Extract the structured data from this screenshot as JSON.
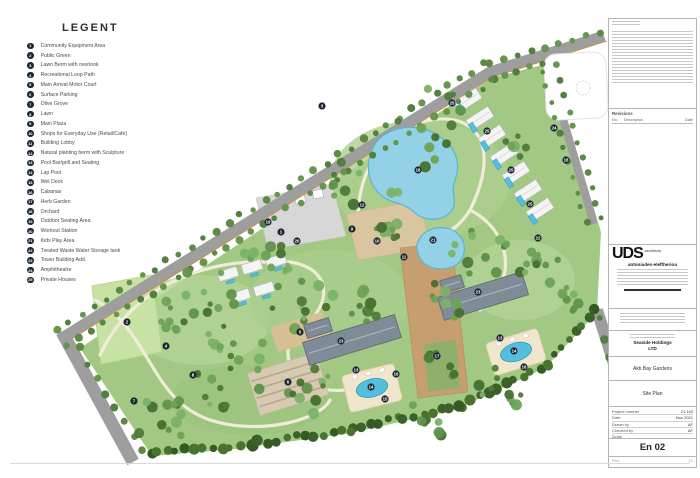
{
  "legend": {
    "title": "LEGENT",
    "items": [
      {
        "n": 1,
        "label": "Community Equipment Area"
      },
      {
        "n": 2,
        "label": "Public Green"
      },
      {
        "n": 3,
        "label": "Lawn Berm with overlook"
      },
      {
        "n": 4,
        "label": "Recreational Loop Path"
      },
      {
        "n": 5,
        "label": "Main Arrival Motor Court"
      },
      {
        "n": 6,
        "label": "Surface Parking"
      },
      {
        "n": 7,
        "label": "Olive Grove"
      },
      {
        "n": 8,
        "label": "Lawn"
      },
      {
        "n": 9,
        "label": "Main Plaza"
      },
      {
        "n": 10,
        "label": "Shops for Everyday Use (Retail/Cafe)"
      },
      {
        "n": 11,
        "label": "Building Lobby"
      },
      {
        "n": 12,
        "label": "Natural planting berm with Sculpture"
      },
      {
        "n": 13,
        "label": "Pool Bar/grill and Seating"
      },
      {
        "n": 14,
        "label": "Lap Pool"
      },
      {
        "n": 15,
        "label": "Wet Deck"
      },
      {
        "n": 16,
        "label": "Cabanas"
      },
      {
        "n": 17,
        "label": "Herb Garden"
      },
      {
        "n": 18,
        "label": "Orchard"
      },
      {
        "n": 19,
        "label": "Outdoor Seating Area"
      },
      {
        "n": 20,
        "label": "Workout Station"
      },
      {
        "n": 21,
        "label": "Kids Play Area"
      },
      {
        "n": 22,
        "label": "Treated Waste Water Storage tank"
      },
      {
        "n": 23,
        "label": "Tower Building Add."
      },
      {
        "n": 24,
        "label": "Amphitheatre"
      },
      {
        "n": 25,
        "label": "Private Houses"
      }
    ]
  },
  "title_block": {
    "revisions_title": "Revisions",
    "revision_columns": [
      "No.",
      "Description",
      "Date"
    ],
    "logo": "UDS",
    "logo_sub": "architects",
    "firm": "antoniades-eleftheriou",
    "client_line1": "Seaside Holdings",
    "client_line2": "LTD",
    "project": "Akti Bay Gardens",
    "drawing": "Site Plan",
    "fields": [
      {
        "label": "Project number",
        "value": "21.140"
      },
      {
        "label": "Date",
        "value": "Nov 2021"
      },
      {
        "label": "Drawn by",
        "value": "AF"
      },
      {
        "label": "Checked by",
        "value": "AF"
      },
      {
        "label": "Scale",
        "value": ""
      }
    ],
    "sheet": "En 02",
    "print_label": "Print",
    "print_value": "1:2"
  },
  "site_plan": {
    "colors": {
      "park": "#a3c883",
      "lawn": "#c8e2a4",
      "road": "#9e9e9e",
      "road_accent": "#cd8a42",
      "pond_fill": "#93d2e6",
      "pond_edge": "#5db3cf",
      "pool_fill": "#55bedd",
      "pool_edge": "#2f9fc2",
      "deck": "#f0e6cc",
      "deck_edge": "#d9cba6",
      "plaza_gray": "#d7d7d7",
      "plaza_tan": "#d9c6a0",
      "axis_tan": "#c79e6f",
      "tower": "#7f8b97",
      "tower_edge": "#5d6873",
      "villa": "#f4f4f4",
      "villa_edge": "#b9b9b9",
      "parking": "#d6cab2",
      "marker": "#1d2734",
      "path": "#f1ecd9"
    },
    "park_outline": "80,348 492,78 550,63 601,232 597,312 545,368 455,410 345,434 235,449 152,456",
    "patches": [
      [
        200,
        320,
        70,
        45,
        "#b2d395"
      ],
      [
        420,
        180,
        90,
        60,
        "#aed08e"
      ],
      [
        330,
        300,
        80,
        50,
        "#a9cd8b"
      ],
      [
        520,
        280,
        55,
        40,
        "#b2d395"
      ],
      [
        250,
        400,
        80,
        35,
        "#9cc47e"
      ]
    ],
    "lawn_quad": "92,286 152,275 162,352 101,364",
    "paths": [
      "M 100,355 C 130,290 200,260 265,262",
      "M 95,300 C 150,330 150,400 210,420 C 260,436 320,420 330,400",
      "M 265,262 C 330,255 340,300 300,330 C 270,355 300,395 345,390",
      "M 360,240 C 350,180 380,130 430,120 C 480,112 500,150 470,210 C 455,235 420,250 395,250",
      "M 470,210 C 510,230 520,280 480,310"
    ],
    "plaza_gray_poly": "256,198 332,184 346,236 268,250",
    "pergolas": [
      [
        280,
        205
      ],
      [
        300,
        199
      ],
      [
        318,
        194
      ]
    ],
    "plaza_tan_poly": "346,214 420,200 430,248 358,260",
    "fountain": [
      388,
      229,
      7
    ],
    "axis_poly": "400,248 452,242 468,392 418,398",
    "courtyard_poly": "424,344 456,340 460,388 428,392",
    "motor_court": {
      "cx": 300,
      "cy": 332,
      "w": 54,
      "h": 26,
      "rot": -17
    },
    "parking": {
      "cx": 288,
      "cy": 384,
      "w": 72,
      "h": 44,
      "rot": -17,
      "stripes": 4
    },
    "roads": [
      {
        "points": [
          [
            62,
            338
          ],
          [
            490,
            72
          ],
          [
            604,
            36
          ]
        ],
        "width": 11
      },
      {
        "points": [
          [
            62,
            332
          ],
          [
            133,
            462
          ]
        ],
        "width": 13
      },
      {
        "points": [
          [
            548,
            68
          ],
          [
            594,
            224
          ]
        ],
        "width": 8
      },
      {
        "points": [
          [
            597,
            310
          ],
          [
            635,
            430
          ]
        ],
        "width": 12
      }
    ],
    "accent_road": 0,
    "white_plot": {
      "cx": 576,
      "cy": 86,
      "w": 62,
      "h": 66,
      "r": 12,
      "rot": -3
    },
    "plot_circle": [
      583,
      88,
      7
    ],
    "ponds": [
      "M 372,150 C 380,128 412,122 432,132 C 455,143 462,162 455,180 C 450,193 458,200 452,210 C 444,222 424,222 414,212 C 404,202 392,204 382,196 C 368,185 365,166 372,150 Z",
      "M 420,238 C 428,226 448,224 458,234 C 468,244 466,260 454,266 C 440,272 424,268 419,256 C 416,248 416,244 420,238 Z"
    ],
    "towers": [
      {
        "cx": 352,
        "cy": 340,
        "w": 96,
        "h": 24,
        "rot": -17
      },
      {
        "cx": 318,
        "cy": 328,
        "w": 26,
        "h": 14,
        "rot": -17
      },
      {
        "cx": 483,
        "cy": 296,
        "w": 88,
        "h": 24,
        "rot": -17
      },
      {
        "cx": 452,
        "cy": 284,
        "w": 22,
        "h": 13,
        "rot": -17
      }
    ],
    "villa_row_ne": {
      "start": [
        468,
        100
      ],
      "step": [
        12,
        18.3
      ],
      "count": 7,
      "w": 26,
      "h": 12,
      "rot": -33,
      "pool_off": [
        -11,
        4
      ],
      "pool_w": 5,
      "pool_h": 10
    },
    "villas_mid": {
      "centers": [
        [
          228,
          274
        ],
        [
          252,
          267
        ],
        [
          276,
          261
        ],
        [
          240,
          296
        ],
        [
          264,
          289
        ]
      ],
      "w": 20,
      "h": 10,
      "rot": -17,
      "pool_off": [
        0,
        8
      ],
      "pool_w": 8,
      "pool_h": 3
    },
    "decks": [
      {
        "cx": 372,
        "cy": 388,
        "w": 54,
        "h": 38,
        "rot": -14
      },
      {
        "cx": 516,
        "cy": 352,
        "w": 54,
        "h": 34,
        "rot": -17
      }
    ],
    "tree_belts": [
      {
        "a": [
          57,
          330
        ],
        "b": [
          485,
          64
        ],
        "n": 36,
        "r": 3.4,
        "jit": 2,
        "pal": "road"
      },
      {
        "a": [
          67,
          346
        ],
        "b": [
          495,
          80
        ],
        "n": 36,
        "r": 3.4,
        "jit": 2,
        "pal": "road"
      },
      {
        "a": [
          490,
          62
        ],
        "b": [
          600,
          32
        ],
        "n": 9,
        "r": 3.2,
        "jit": 1.5,
        "pal": "road"
      },
      {
        "a": [
          492,
          78
        ],
        "b": [
          542,
          64
        ],
        "n": 5,
        "r": 3.2,
        "jit": 1.5,
        "pal": "road"
      },
      {
        "a": [
          542,
          72
        ],
        "b": [
          586,
          222
        ],
        "n": 11,
        "r": 3,
        "jit": 1.5,
        "pal": "road"
      },
      {
        "a": [
          556,
          66
        ],
        "b": [
          600,
          218
        ],
        "n": 11,
        "r": 3,
        "jit": 1.5,
        "pal": "road"
      },
      {
        "a": [
          80,
          348
        ],
        "b": [
          142,
          452
        ],
        "n": 8,
        "r": 3.5,
        "jit": 2,
        "pal": "road"
      },
      {
        "a": [
          150,
          452
        ],
        "b": [
          250,
          444
        ],
        "n": 12,
        "r": 4.6,
        "jit": 3,
        "pal": "dark"
      },
      {
        "a": [
          250,
          444
        ],
        "b": [
          350,
          430
        ],
        "n": 12,
        "r": 4.6,
        "jit": 3,
        "pal": "dark"
      },
      {
        "a": [
          350,
          430
        ],
        "b": [
          460,
          405
        ],
        "n": 13,
        "r": 4.6,
        "jit": 3,
        "pal": "dark"
      },
      {
        "a": [
          460,
          405
        ],
        "b": [
          548,
          364
        ],
        "n": 11,
        "r": 4.6,
        "jit": 3,
        "pal": "dark"
      },
      {
        "a": [
          548,
          364
        ],
        "b": [
          596,
          310
        ],
        "n": 8,
        "r": 4.4,
        "jit": 3,
        "pal": "dark"
      },
      {
        "a": [
          598,
          318
        ],
        "b": [
          628,
          420
        ],
        "n": 6,
        "r": 3.5,
        "jit": 2,
        "pal": "road"
      }
    ],
    "tree_clusters": [
      [
        195,
        300,
        40,
        20
      ],
      [
        300,
        295,
        36,
        16
      ],
      [
        235,
        372,
        42,
        20
      ],
      [
        162,
        418,
        28,
        12
      ],
      [
        350,
        182,
        24,
        9
      ],
      [
        432,
        128,
        40,
        12
      ],
      [
        390,
        215,
        26,
        9
      ],
      [
        480,
        255,
        30,
        12
      ],
      [
        543,
        262,
        26,
        10
      ],
      [
        573,
        298,
        18,
        7
      ],
      [
        312,
        392,
        26,
        11
      ],
      [
        498,
        392,
        26,
        10
      ],
      [
        432,
        416,
        22,
        8
      ],
      [
        262,
        250,
        22,
        9
      ],
      [
        520,
        148,
        16,
        6
      ],
      [
        445,
        300,
        20,
        8
      ],
      [
        365,
        300,
        22,
        9
      ],
      [
        440,
        365,
        18,
        6
      ]
    ],
    "markers": [
      [
        3,
        322,
        106
      ],
      [
        25,
        452,
        103
      ],
      [
        25,
        487,
        131
      ],
      [
        25,
        511,
        170
      ],
      [
        25,
        530,
        204
      ],
      [
        24,
        554,
        128
      ],
      [
        18,
        566,
        160
      ],
      [
        18,
        418,
        170
      ],
      [
        12,
        362,
        205
      ],
      [
        21,
        433,
        240
      ],
      [
        22,
        538,
        238
      ],
      [
        11,
        404,
        257
      ],
      [
        10,
        377,
        241
      ],
      [
        9,
        352,
        229
      ],
      [
        19,
        268,
        222
      ],
      [
        20,
        297,
        241
      ],
      [
        1,
        281,
        232
      ],
      [
        2,
        127,
        322
      ],
      [
        4,
        166,
        346
      ],
      [
        8,
        193,
        375
      ],
      [
        7,
        134,
        401
      ],
      [
        5,
        300,
        332
      ],
      [
        6,
        288,
        382
      ],
      [
        23,
        341,
        341
      ],
      [
        23,
        478,
        292
      ],
      [
        13,
        356,
        370
      ],
      [
        14,
        371,
        387
      ],
      [
        15,
        385,
        399
      ],
      [
        16,
        396,
        374
      ],
      [
        13,
        500,
        338
      ],
      [
        14,
        514,
        351
      ],
      [
        16,
        524,
        367
      ],
      [
        17,
        437,
        356
      ]
    ]
  }
}
